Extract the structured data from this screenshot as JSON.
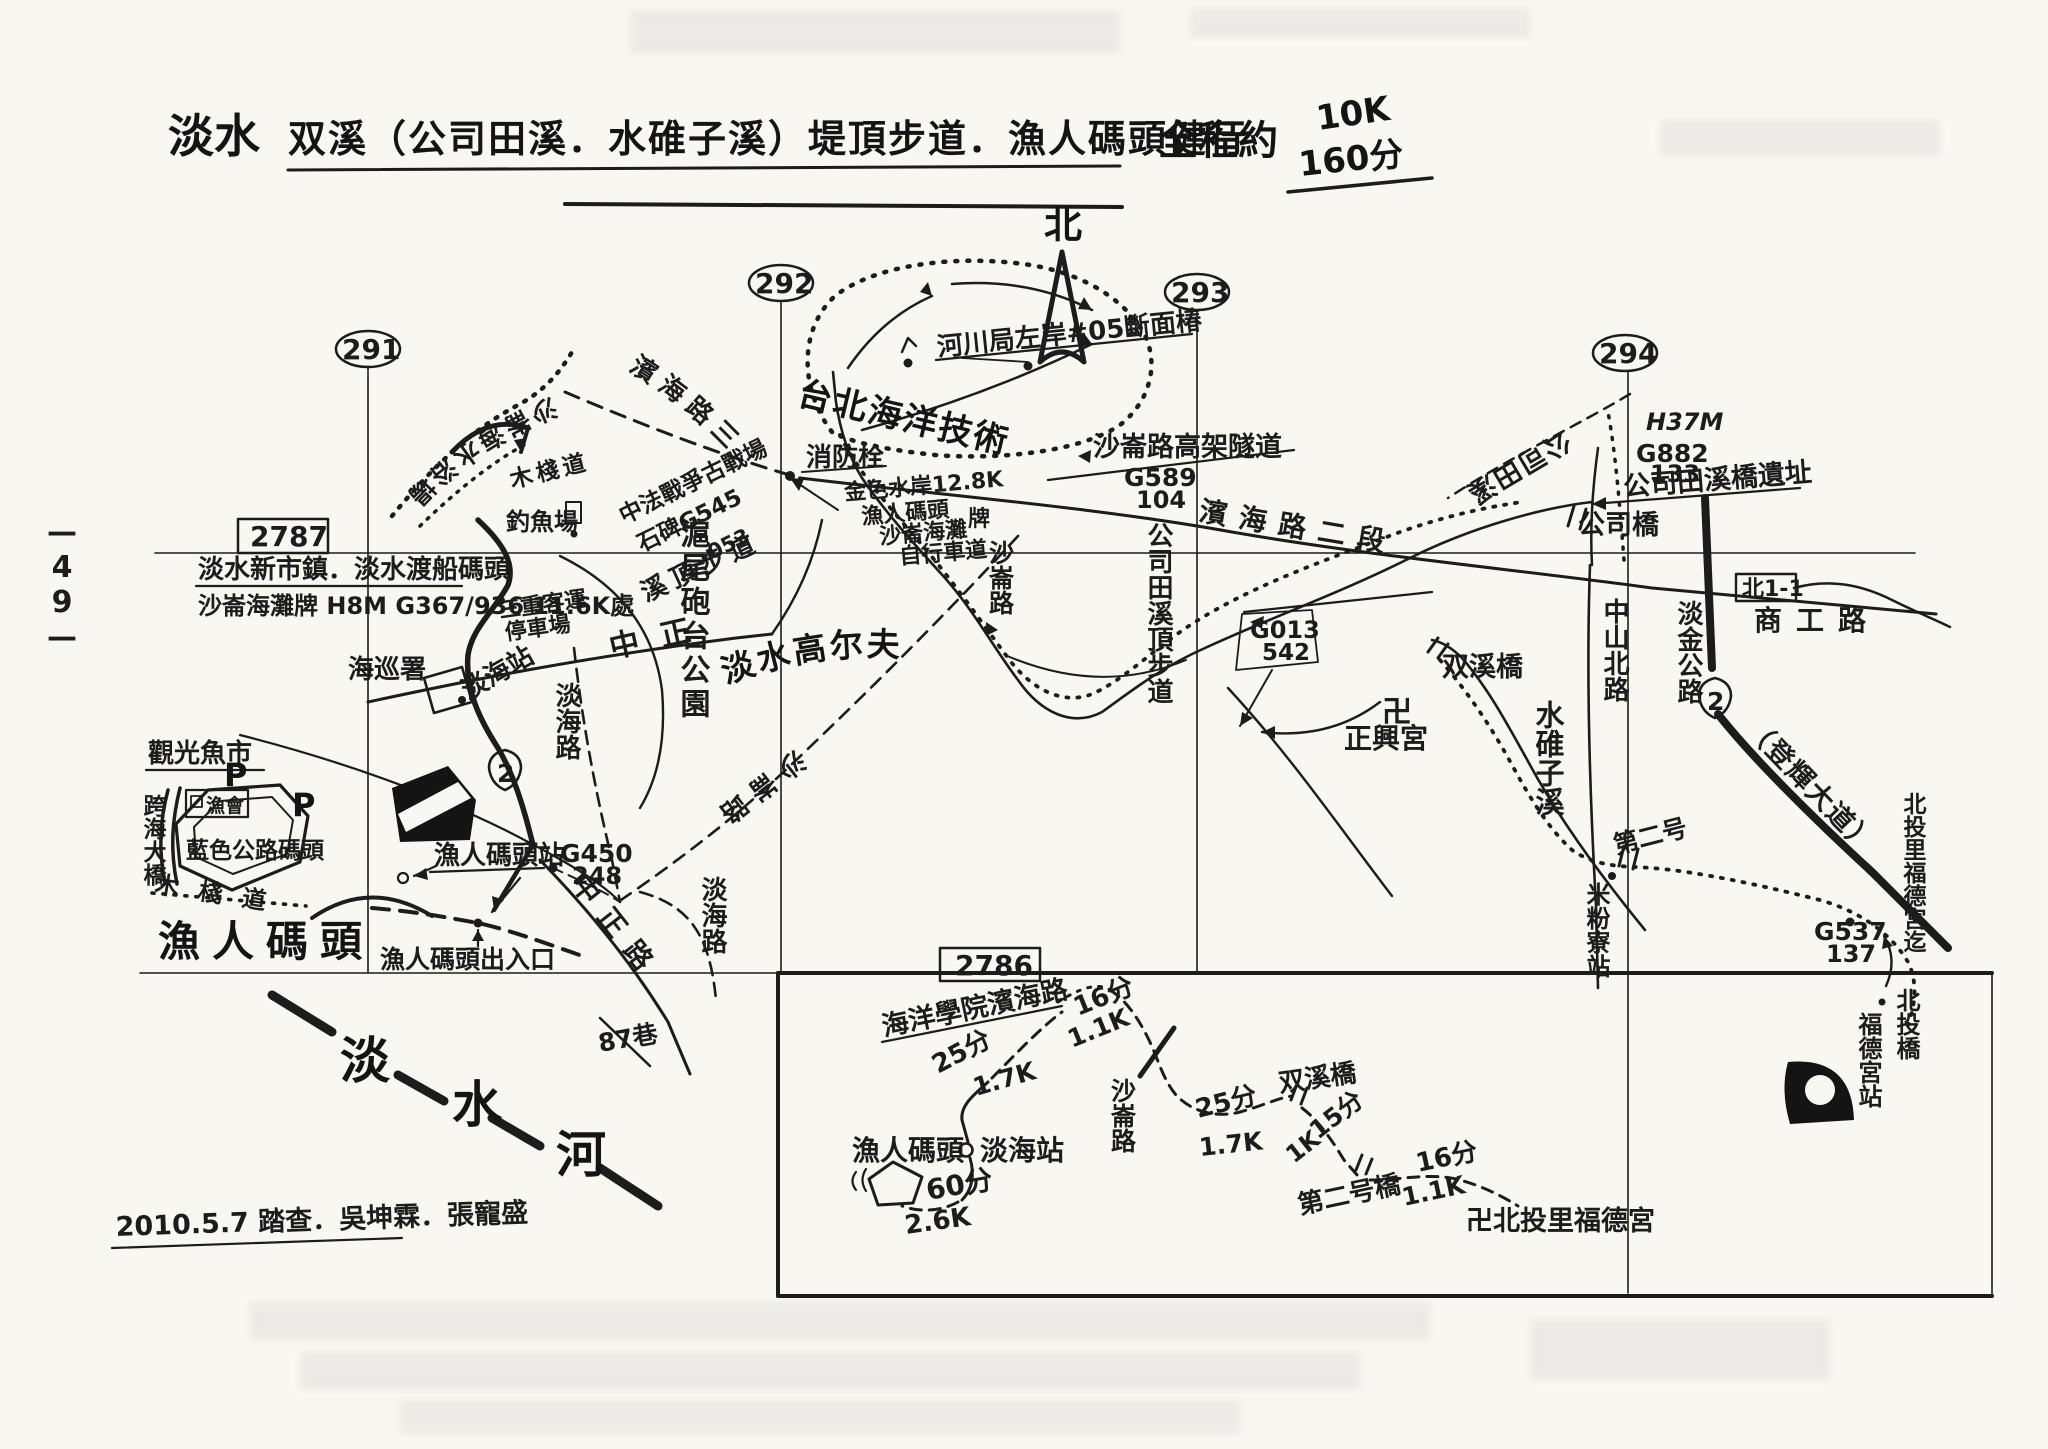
{
  "page": {
    "side_number": "—49—",
    "survey_note": "2010.5.7 踏查．吳坤霖．張寵盛",
    "ink_color": "#1c1c1c",
    "paper_color": "#f8f7f2"
  },
  "title": {
    "area": "淡水",
    "route": "双溪（公司田溪．水碓子溪）堤頂步道．漁人碼頭健行",
    "total_label": "全程約",
    "total_distance": "10K",
    "total_time": "160分"
  },
  "compass": {
    "north": "北"
  },
  "grid": {
    "col_291": "291",
    "col_292": "292",
    "col_293": "293",
    "col_294": "294",
    "row_2787": "2787",
    "row_2786": "2786"
  },
  "roads": {
    "binhai_sec3": "濱海路三段",
    "binhai_sec2": "濱海路二段",
    "zhongzheng_rd": "中正路",
    "danhai_rd": "淡海路",
    "shalun_rd": "沙崙路",
    "lane_87": "87巷",
    "zhongshan_n_rd": "中山北路",
    "danjin_hwy": "淡金公路",
    "denghui_blvd": "（登輝大道）",
    "shanggong_rd": "商工路",
    "hwy2_badge": "2",
    "route_box": "北1-1",
    "shalun_viaduct": "沙崙路高架隧道"
  },
  "waters": {
    "tamsui_river": [
      "淡",
      "水",
      "河"
    ],
    "gongsitian_creek": "公司田溪",
    "gongsitian_levee": "公司田溪頂步道",
    "shuiduizi_creek": "水碓子溪",
    "xiding_trail": "溪頂步道"
  },
  "places": {
    "shalun_beach": "沙崙海水浴場",
    "boardwalk": "木棧道",
    "fishing_area": "釣魚場",
    "war_site_line1": "中法戰爭古戰場",
    "war_site_line2": "石碑G545",
    "war_site_line3": "053",
    "newtown_note": "淡水新市鎮．淡水渡船碼頭",
    "beach_marker_note": "沙崙海灘牌 H8M G367/936 11.6K處",
    "bus_depot_line1": "三重客運",
    "bus_depot_line2": "停車場",
    "coast_guard": "海巡署",
    "danhai_stop": "淡海站",
    "ocean_college": "台北海洋技術學院",
    "fire_hydrant": "消防栓",
    "golden_coast_line1": "金色水岸12.8K",
    "golden_coast_line2": "漁人碼頭",
    "golden_coast_line3": "沙崙海灘",
    "golden_coast_line4": "自行車道",
    "golden_coast_sign": "牌",
    "river_bureau_note": "河川局左岸#05斷面椿",
    "intake_note": "沙崙圳取水口石碑",
    "huwei_fort_park": "滬尾砲台公園",
    "golf_course": "淡水高尔夫球場",
    "zhengxing_temple": "正興宮",
    "swastika": "卍",
    "shuangxi_bridge": "双溪橋",
    "bridge_ruins": "公司田溪橋遺址",
    "bridge_ruins_h": "H37M",
    "gongsi_bridge": "公司橋",
    "second_bridge": "第二号橋",
    "mifenliao_stop": "米粉寮站",
    "beitou_bridge": "北投橋",
    "fudegong_stop": "福德宮站",
    "beitou_fudegong_end": "北投里福德宮迄",
    "fish_market": "觀光魚市",
    "parking": "P",
    "fishers_assoc": "漁會",
    "blue_highway_pier": "藍色公路碼頭",
    "cross_sea_bridge": "跨海大橋",
    "fishermans_wharf": "漁人碼頭",
    "wharf_station": "漁人碼頭站",
    "wharf_entrance": "漁人碼頭出入口"
  },
  "markers": {
    "g450": {
      "top": "G450",
      "bottom": "248"
    },
    "g589": {
      "top": "G589",
      "bottom": "104"
    },
    "g013": {
      "top": "G013",
      "bottom": "542"
    },
    "g882": {
      "top": "G882",
      "bottom": "133"
    },
    "g537": {
      "top": "G537",
      "bottom": "137"
    }
  },
  "inset": {
    "college_gate": "海洋學院濱海路口",
    "time_25": "25分",
    "dist_17": "1.7K",
    "time_16": "16分",
    "dist_11": "1.1K",
    "time_15": "15分",
    "dist_1k": "1K",
    "time_60": "60分",
    "dist_26": "2.6K",
    "endpoint": "卍北投里福德宮"
  }
}
